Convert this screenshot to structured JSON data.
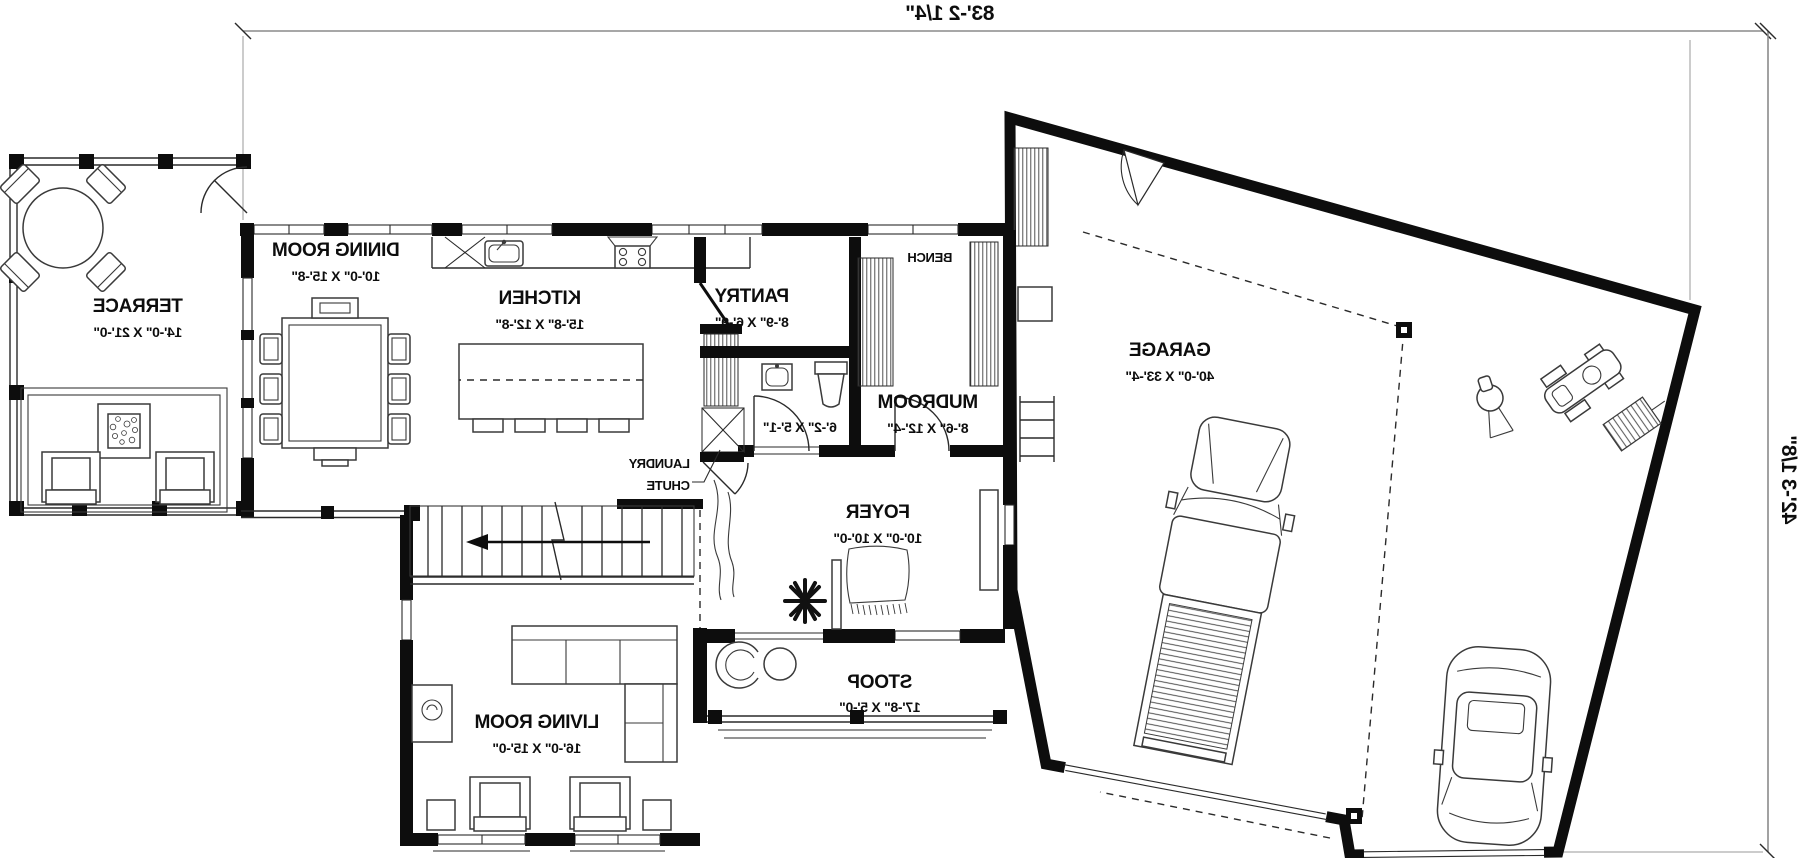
{
  "plan": {
    "dim_width": "83'-2 1/4\"",
    "dim_height": "42'-3 1/8\"",
    "rooms": {
      "terrace": {
        "name": "TERRACE",
        "size": "14'-0\" X 21'-0\""
      },
      "dining": {
        "name": "DINING ROOM",
        "size": "10'-0\" X 15'-8\""
      },
      "kitchen": {
        "name": "KITCHEN",
        "size": "15'-8\" X 12'-8\""
      },
      "pantry": {
        "name": "PANTRY",
        "size": "8'-9\" X 6'-9\""
      },
      "powder": {
        "size": "6'-2\" X 5'-1\""
      },
      "mudroom": {
        "name": "MUDROOM",
        "size": "8'-6\" X 12'-4\""
      },
      "foyer": {
        "name": "FOYER",
        "size": "10'-0\" X 10'-0\""
      },
      "living": {
        "name": "LIVING ROOM",
        "size": "16'-0\" X 15'-0\""
      },
      "stoop": {
        "name": "STOOP",
        "size": "17'-8\" X 5'-0\""
      },
      "garage": {
        "name": "GARAGE",
        "size": "40'-0\" X 33'-4\""
      }
    },
    "annotations": {
      "bench": "BENCH",
      "laundry1": "LAUNDRY",
      "laundry2": "CHUTE"
    },
    "colors": {
      "ink": "#0d0d0d",
      "paper": "#ffffff"
    }
  }
}
